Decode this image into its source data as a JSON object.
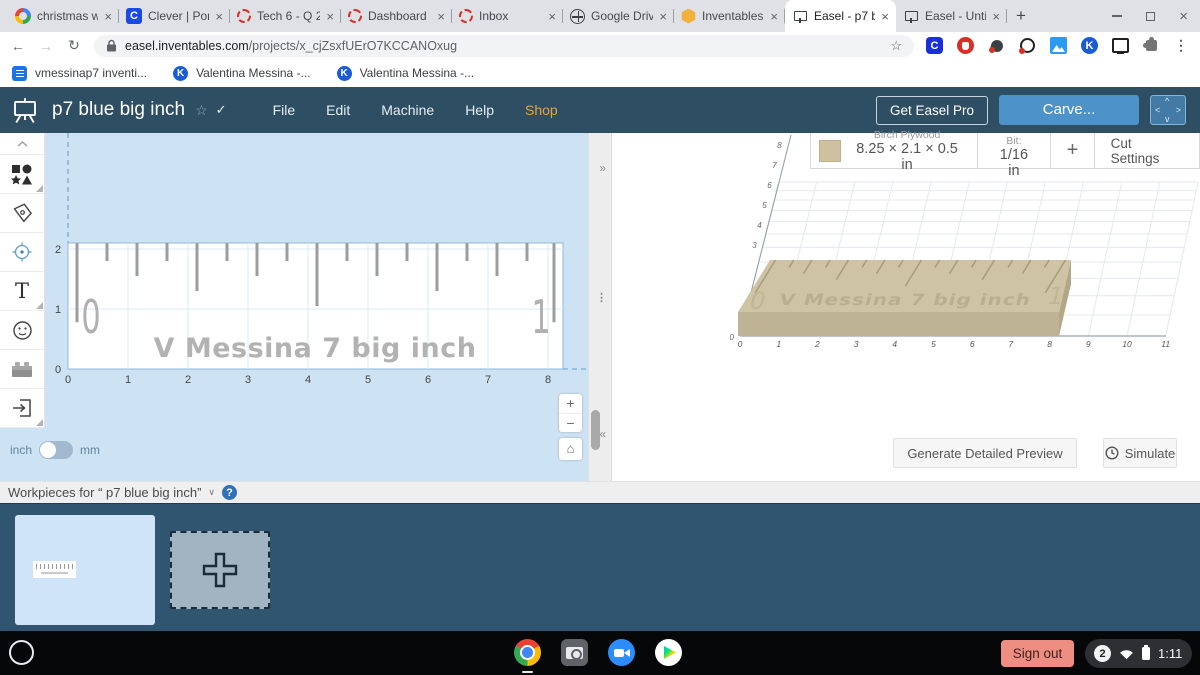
{
  "browser": {
    "tabs": [
      {
        "title": "christmas w",
        "favicon": "google"
      },
      {
        "title": "Clever | Port",
        "favicon": "clever"
      },
      {
        "title": "Tech 6 - Q 2",
        "favicon": "loading"
      },
      {
        "title": "Dashboard",
        "favicon": "loading"
      },
      {
        "title": "Inbox",
        "favicon": "loading"
      },
      {
        "title": "Google Driv",
        "favicon": "globe"
      },
      {
        "title": "Inventables",
        "favicon": "inventables"
      },
      {
        "title": "Easel - p7 b",
        "favicon": "easel",
        "active": true
      },
      {
        "title": "Easel - Untit",
        "favicon": "easel"
      }
    ],
    "tab_close_glyph": "×",
    "new_tab_glyph": "+",
    "close_glyph": "×",
    "nav": {
      "back": "←",
      "forward": "→",
      "reload": "↻"
    },
    "url": {
      "domain": "easel.inventables.com",
      "path": "/projects/x_cjZsxfUErO7KCCANOxug"
    },
    "omnibox_star": "☆",
    "extensions": [
      "clever",
      "stop",
      "paddle",
      "target",
      "screenshot",
      "kami",
      "cast",
      "puzzle"
    ],
    "menu_glyph": "⋮",
    "bookmarks": [
      {
        "label": "vmessinap7 inventi...",
        "icon": "docs"
      },
      {
        "label": "Valentina Messina -...",
        "icon": "kami"
      },
      {
        "label": "Valentina Messina -...",
        "icon": "kami"
      }
    ]
  },
  "header": {
    "project_title": "p7 blue big inch",
    "star_glyph": "☆",
    "saved_glyph": "✓",
    "menus": [
      "File",
      "Edit",
      "Machine",
      "Help",
      "Shop"
    ],
    "get_pro_label": "Get Easel Pro",
    "carve_label": "Carve...",
    "jog": {
      "up": "^",
      "left": "<",
      "right": ">",
      "down": "v"
    },
    "colors": {
      "bar": "#2d4e63",
      "carve": "#4d92c8",
      "shop_accent": "#e8a33d"
    }
  },
  "canvas": {
    "x_labels": [
      "0",
      "1",
      "2",
      "3",
      "4",
      "5",
      "6",
      "7",
      "8"
    ],
    "y_labels": [
      "0",
      "1",
      "2"
    ],
    "units": {
      "inch": "inch",
      "mm": "mm"
    },
    "zoom_in": "+",
    "zoom_out": "−",
    "home_glyph": "⌂",
    "expand_glyph": "»",
    "collapse_glyph": "«",
    "handle_glyph": "⋮"
  },
  "design": {
    "name_text": "V Messina 7 big inch",
    "left_end_label": "0",
    "right_end_label": "1",
    "material_width_in": 8.25,
    "material_height_in": 2.1,
    "ruler_ticks": [
      {
        "x": 0.15,
        "len": 1.32
      },
      {
        "x": 0.65,
        "len": 0.3
      },
      {
        "x": 1.15,
        "len": 0.55
      },
      {
        "x": 1.65,
        "len": 0.3
      },
      {
        "x": 2.15,
        "len": 0.8
      },
      {
        "x": 2.65,
        "len": 0.3
      },
      {
        "x": 3.15,
        "len": 0.55
      },
      {
        "x": 3.65,
        "len": 0.3
      },
      {
        "x": 4.15,
        "len": 1.05
      },
      {
        "x": 4.65,
        "len": 0.3
      },
      {
        "x": 5.15,
        "len": 0.55
      },
      {
        "x": 5.65,
        "len": 0.3
      },
      {
        "x": 6.15,
        "len": 0.8
      },
      {
        "x": 6.65,
        "len": 0.3
      },
      {
        "x": 7.15,
        "len": 0.55
      },
      {
        "x": 7.65,
        "len": 0.3
      },
      {
        "x": 8.1,
        "len": 1.32
      }
    ]
  },
  "preview": {
    "material_name": "Birch Plywood",
    "material_dims": "8.25 × 2.1 × 0.5 in",
    "bit_label": "Bit:",
    "bit_value": "1/16 in",
    "add_bit_glyph": "+",
    "cut_settings_label": "Cut Settings",
    "x_labels": [
      "0",
      "1",
      "2",
      "3",
      "4",
      "5",
      "6",
      "7",
      "8",
      "9",
      "10",
      "11"
    ],
    "side_labels": [
      "3",
      "4",
      "5",
      "6",
      "7",
      "8"
    ],
    "origin_label": "0",
    "generate_label": "Generate Detailed Preview",
    "simulate_label": "Simulate"
  },
  "workpieces": {
    "label": "Workpieces for “ p7 blue big inch”",
    "collapse_glyph": "∨",
    "help_glyph": "?"
  },
  "shelf": {
    "apps": [
      "chrome",
      "camera",
      "zoom",
      "play"
    ],
    "sign_out_label": "Sign out",
    "badge": "2",
    "time": "1:11"
  }
}
